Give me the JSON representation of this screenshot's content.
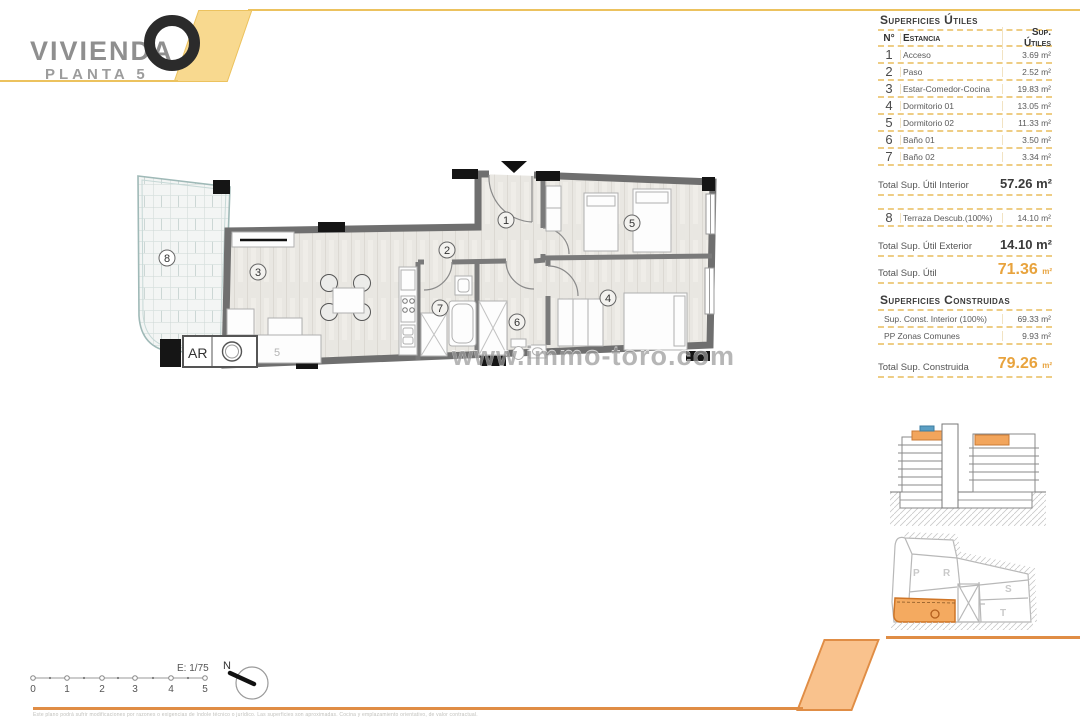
{
  "logo": {
    "title": "VIVIENDA",
    "ring": "O",
    "subtitle": "PLANTA 5"
  },
  "panel": {
    "utiles": {
      "heading": "Superficies Útiles",
      "col_num": "N°",
      "col_room": "Estancia",
      "col_sup": "Sup. Útiles",
      "rows": [
        {
          "num": "1",
          "name": "Acceso",
          "sup": "3.69 m²"
        },
        {
          "num": "2",
          "name": "Paso",
          "sup": "2.52 m²"
        },
        {
          "num": "3",
          "name": "Estar-Comedor-Cocina",
          "sup": "19.83 m²"
        },
        {
          "num": "4",
          "name": "Dormitorio 01",
          "sup": "13.05 m²"
        },
        {
          "num": "5",
          "name": "Dormitorio 02",
          "sup": "11.33 m²"
        },
        {
          "num": "6",
          "name": "Baño 01",
          "sup": "3.50 m²"
        },
        {
          "num": "7",
          "name": "Baño 02",
          "sup": "3.34 m²"
        }
      ],
      "total_interior_label": "Total Sup. Útil Interior",
      "total_interior": "57.26 m²",
      "row8": {
        "num": "8",
        "name": "Terraza Descub.(100%)",
        "sup": "14.10 m²"
      },
      "total_exterior_label": "Total Sup. Útil Exterior",
      "total_exterior": "14.10 m²",
      "total_label": "Total Sup. Útil",
      "total_value": "71.36",
      "total_unit": "m²"
    },
    "construidas": {
      "heading": "Superficies Construidas",
      "rows": [
        {
          "name": "Sup. Const. Interior (100%)",
          "sup": "69.33 m²"
        },
        {
          "name": "PP Zonas Comunes",
          "sup": "9.93 m²"
        }
      ],
      "total_label": "Total Sup. Construida",
      "total_value": "79.26",
      "total_unit": "m²"
    }
  },
  "plan": {
    "rooms": [
      {
        "num": "1"
      },
      {
        "num": "2"
      },
      {
        "num": "3"
      },
      {
        "num": "4"
      },
      {
        "num": "5"
      },
      {
        "num": "6"
      },
      {
        "num": "7"
      },
      {
        "num": "8"
      }
    ],
    "ar_label": "AR",
    "extra_label": "5",
    "watermark": "www.immo-toro.com"
  },
  "siteplan": {
    "p": "P",
    "r": "R",
    "s": "S",
    "t": "T",
    "o": "o"
  },
  "footer": {
    "scale_label": "E: 1/75",
    "north_label": "N",
    "ticks": [
      "0",
      "1",
      "2",
      "3",
      "4",
      "5"
    ],
    "disclaimer": "Este plano podrá sufrir modificaciones por razones o exigencias de índole técnico o jurídico. Las superficies son aproximadas. Cocina y emplazamiento orientativo, de valor contractual."
  },
  "colors": {
    "accent_yellow": "#f8d98f",
    "accent_orange_fill": "#f9c28d",
    "line_yellow": "#ecc25e",
    "line_orange": "#e08d45",
    "total_orange": "#e8a33d",
    "dash_tan": "#eecd85",
    "wall_gray": "#6f6f6f",
    "highlight_orange": "#f2a55c",
    "highlight_blue": "#5b9fc4"
  }
}
